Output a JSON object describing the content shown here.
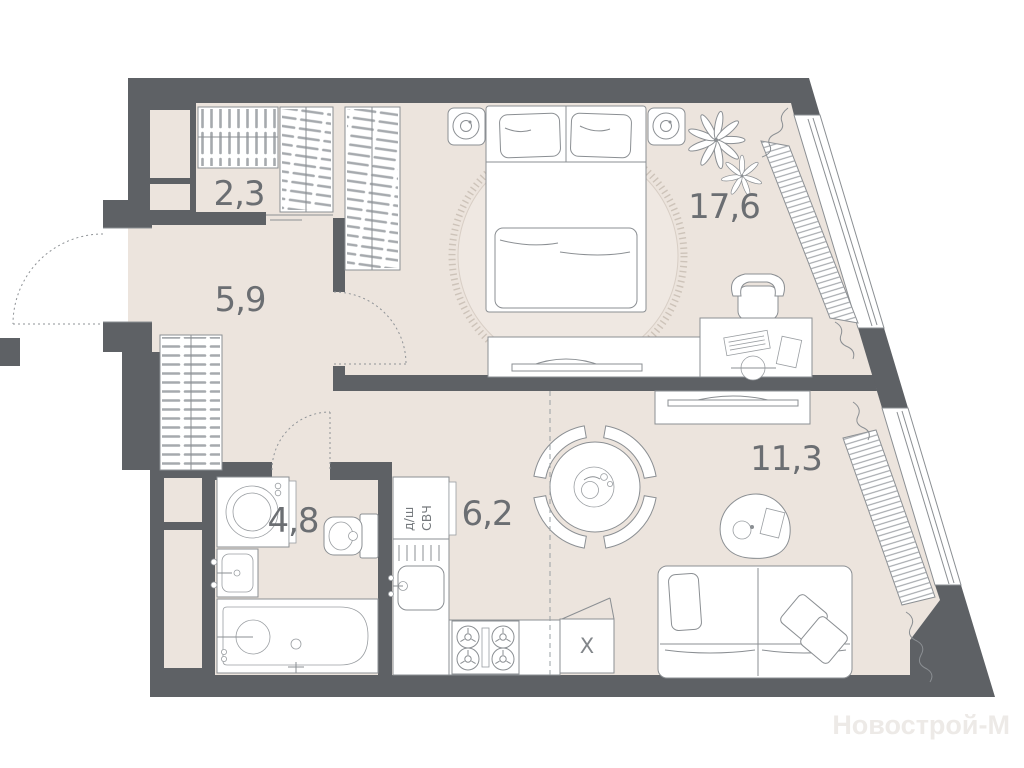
{
  "plan": {
    "title": "apartment-floor-plan",
    "watermark": "Новострой-М",
    "rooms": [
      {
        "id": "wardrobe",
        "area": "2,3"
      },
      {
        "id": "hallway",
        "area": "5,9"
      },
      {
        "id": "bedroom",
        "area": "17,6"
      },
      {
        "id": "kitchen-zone",
        "area": "6,2"
      },
      {
        "id": "living-zone",
        "area": "11,3"
      },
      {
        "id": "bathroom",
        "area": "4,8"
      }
    ],
    "appliance_labels": {
      "dishwasher": "д/ш",
      "microwave": "СВЧ",
      "fridge": "X"
    },
    "colors": {
      "wall": "#5e6165",
      "floor": "#ece4dd",
      "rug": "#efe8e2",
      "furniture_outline": "#8b8f93",
      "label": "#6b6e72"
    }
  }
}
